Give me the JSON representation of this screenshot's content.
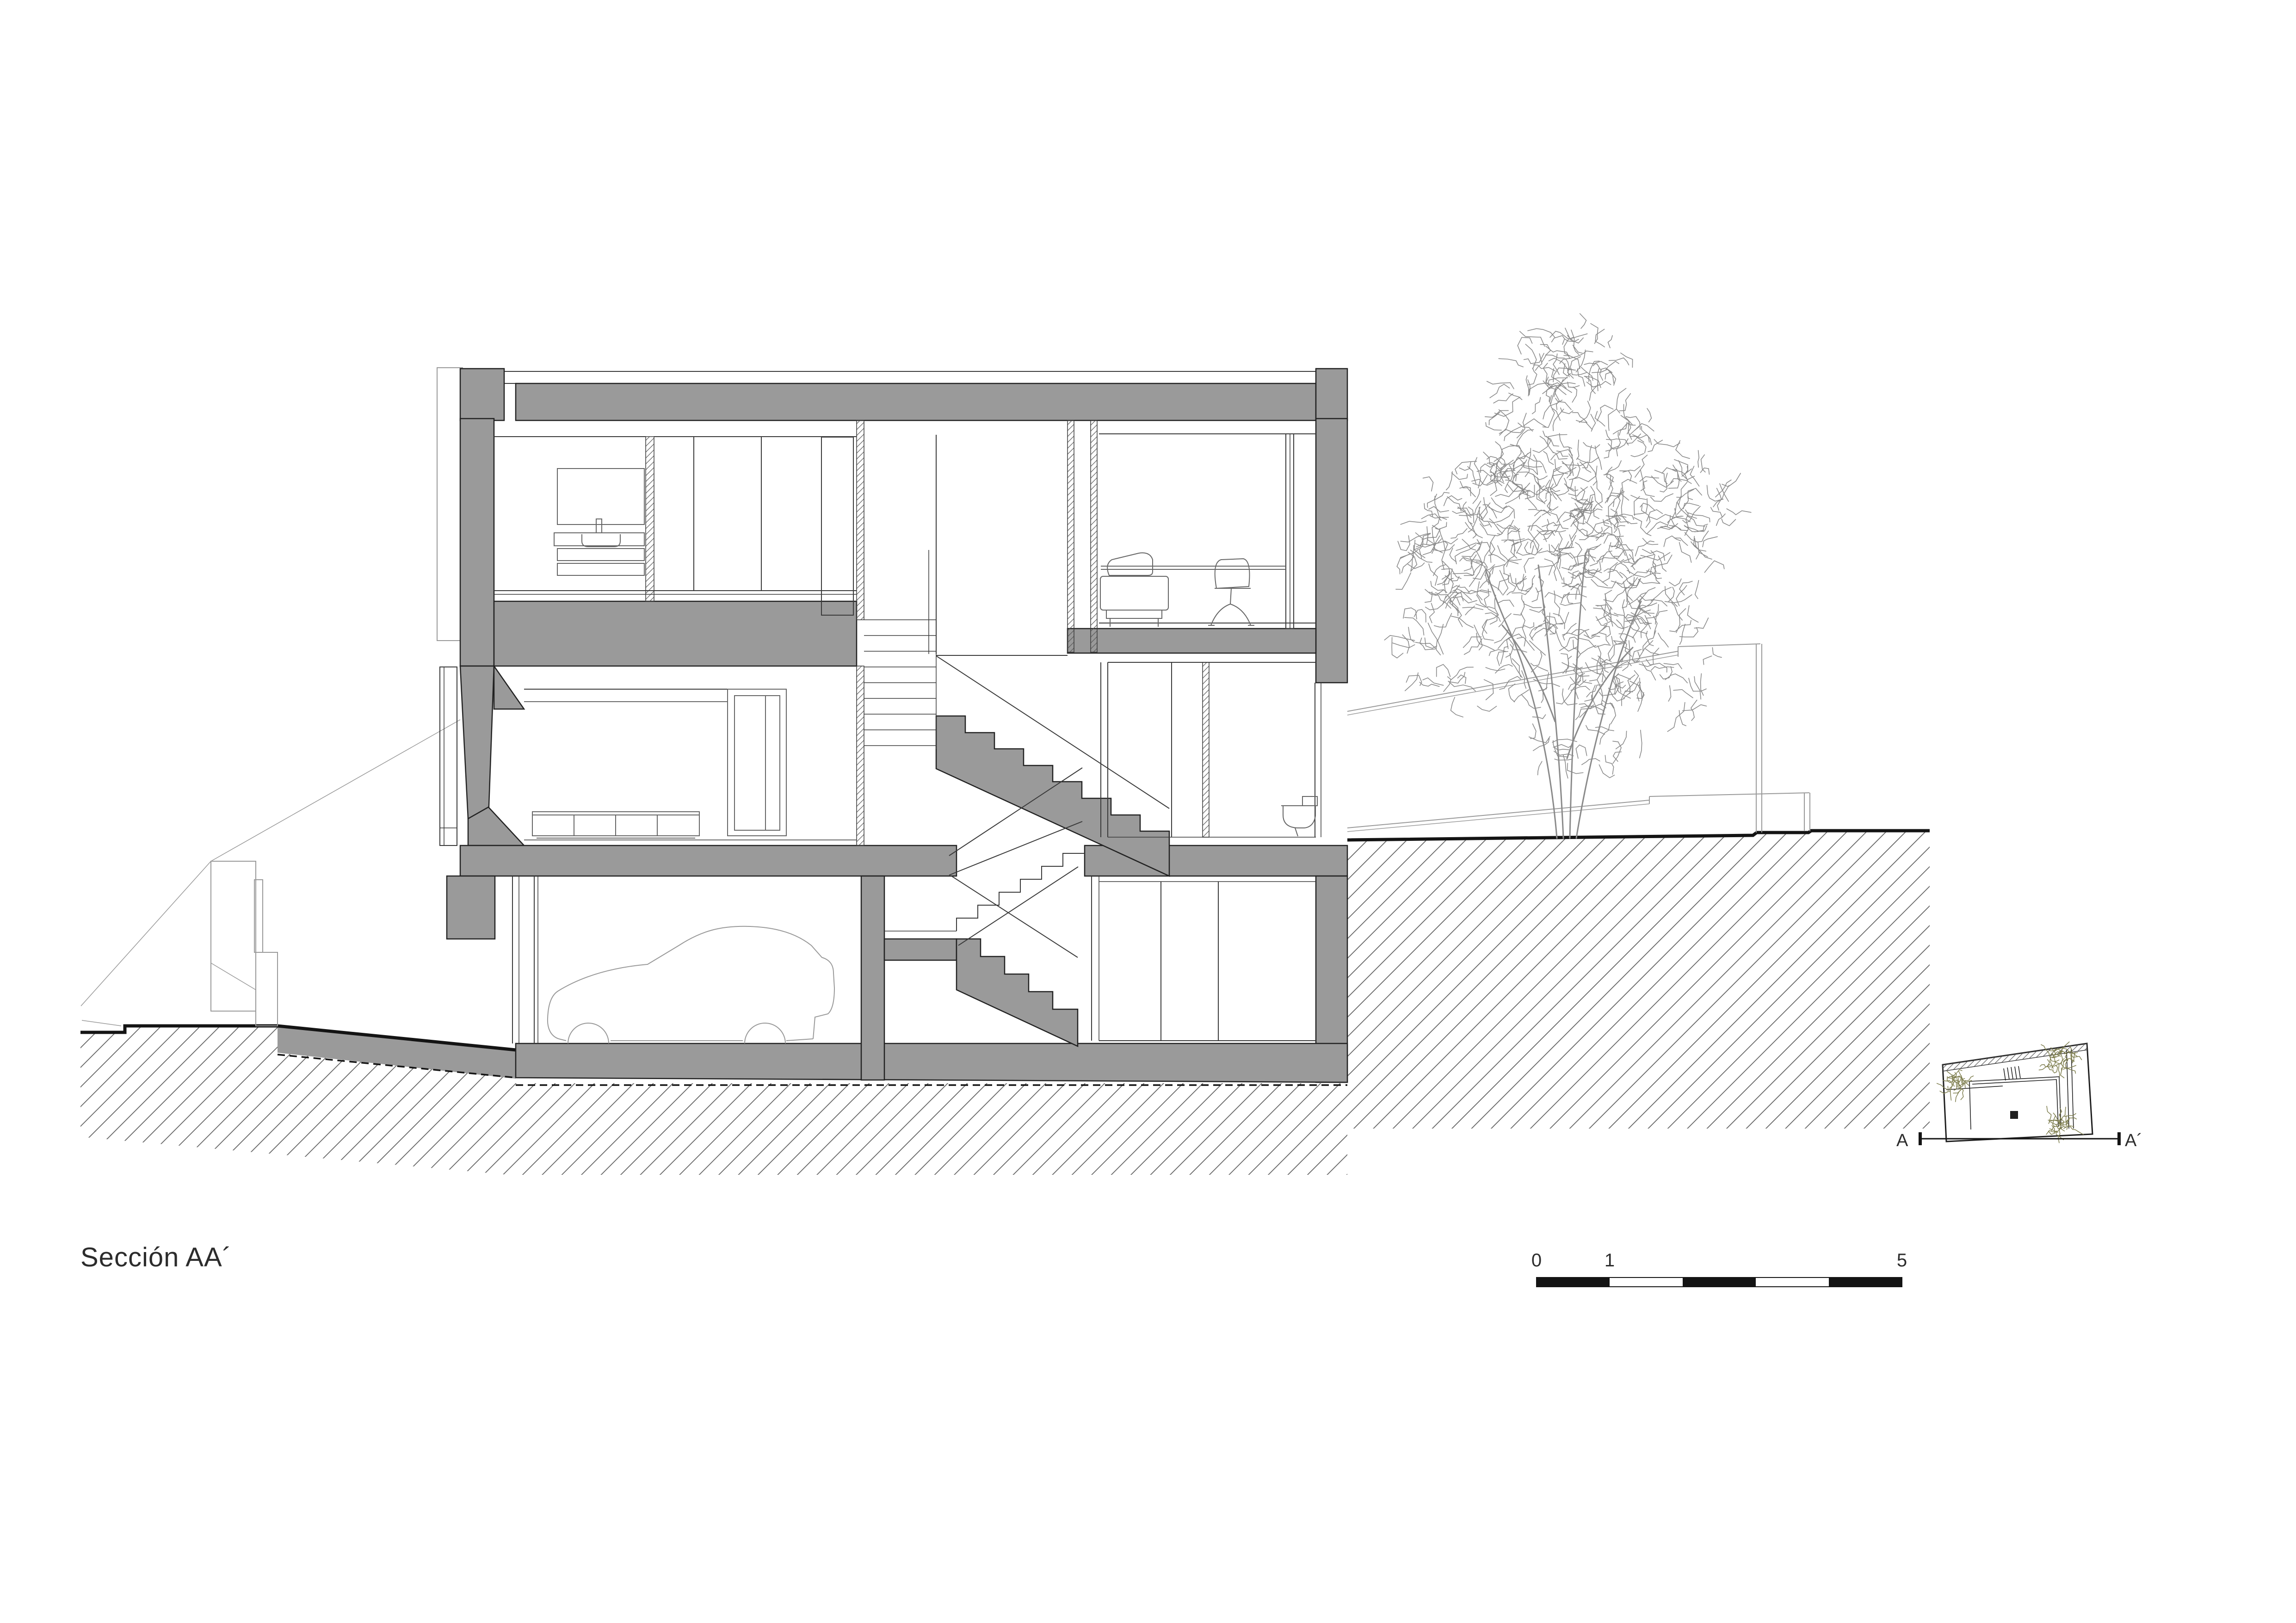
{
  "title": {
    "label": "Sección AA´"
  },
  "scale_bar": {
    "labels": [
      "0",
      "1",
      "5"
    ]
  },
  "key_plan": {
    "label_a": "A",
    "label_a_prime": "A´"
  },
  "drawing": {
    "type": "architectural building cross-section",
    "elements": [
      "roof slab",
      "upper floor",
      "middle floor",
      "basement garage",
      "staircase",
      "car silhouette",
      "tree",
      "earth hatch",
      "driveway ramp",
      "garden walls",
      "key plan"
    ]
  },
  "colors": {
    "background": "#ffffff",
    "poche_gray": "#9a9a9a",
    "cut_line": "#222222",
    "thin_line": "#3a3a3a",
    "furniture_line": "#666666",
    "elevation_line": "#999999",
    "earth_hatch_line": "#606060",
    "ground_line": "#141414",
    "tree_line": "#8a8a8a",
    "plan_line": "#1f1f1f",
    "plant_olive": "#7e7e4e",
    "text": "#2c2c2c"
  }
}
